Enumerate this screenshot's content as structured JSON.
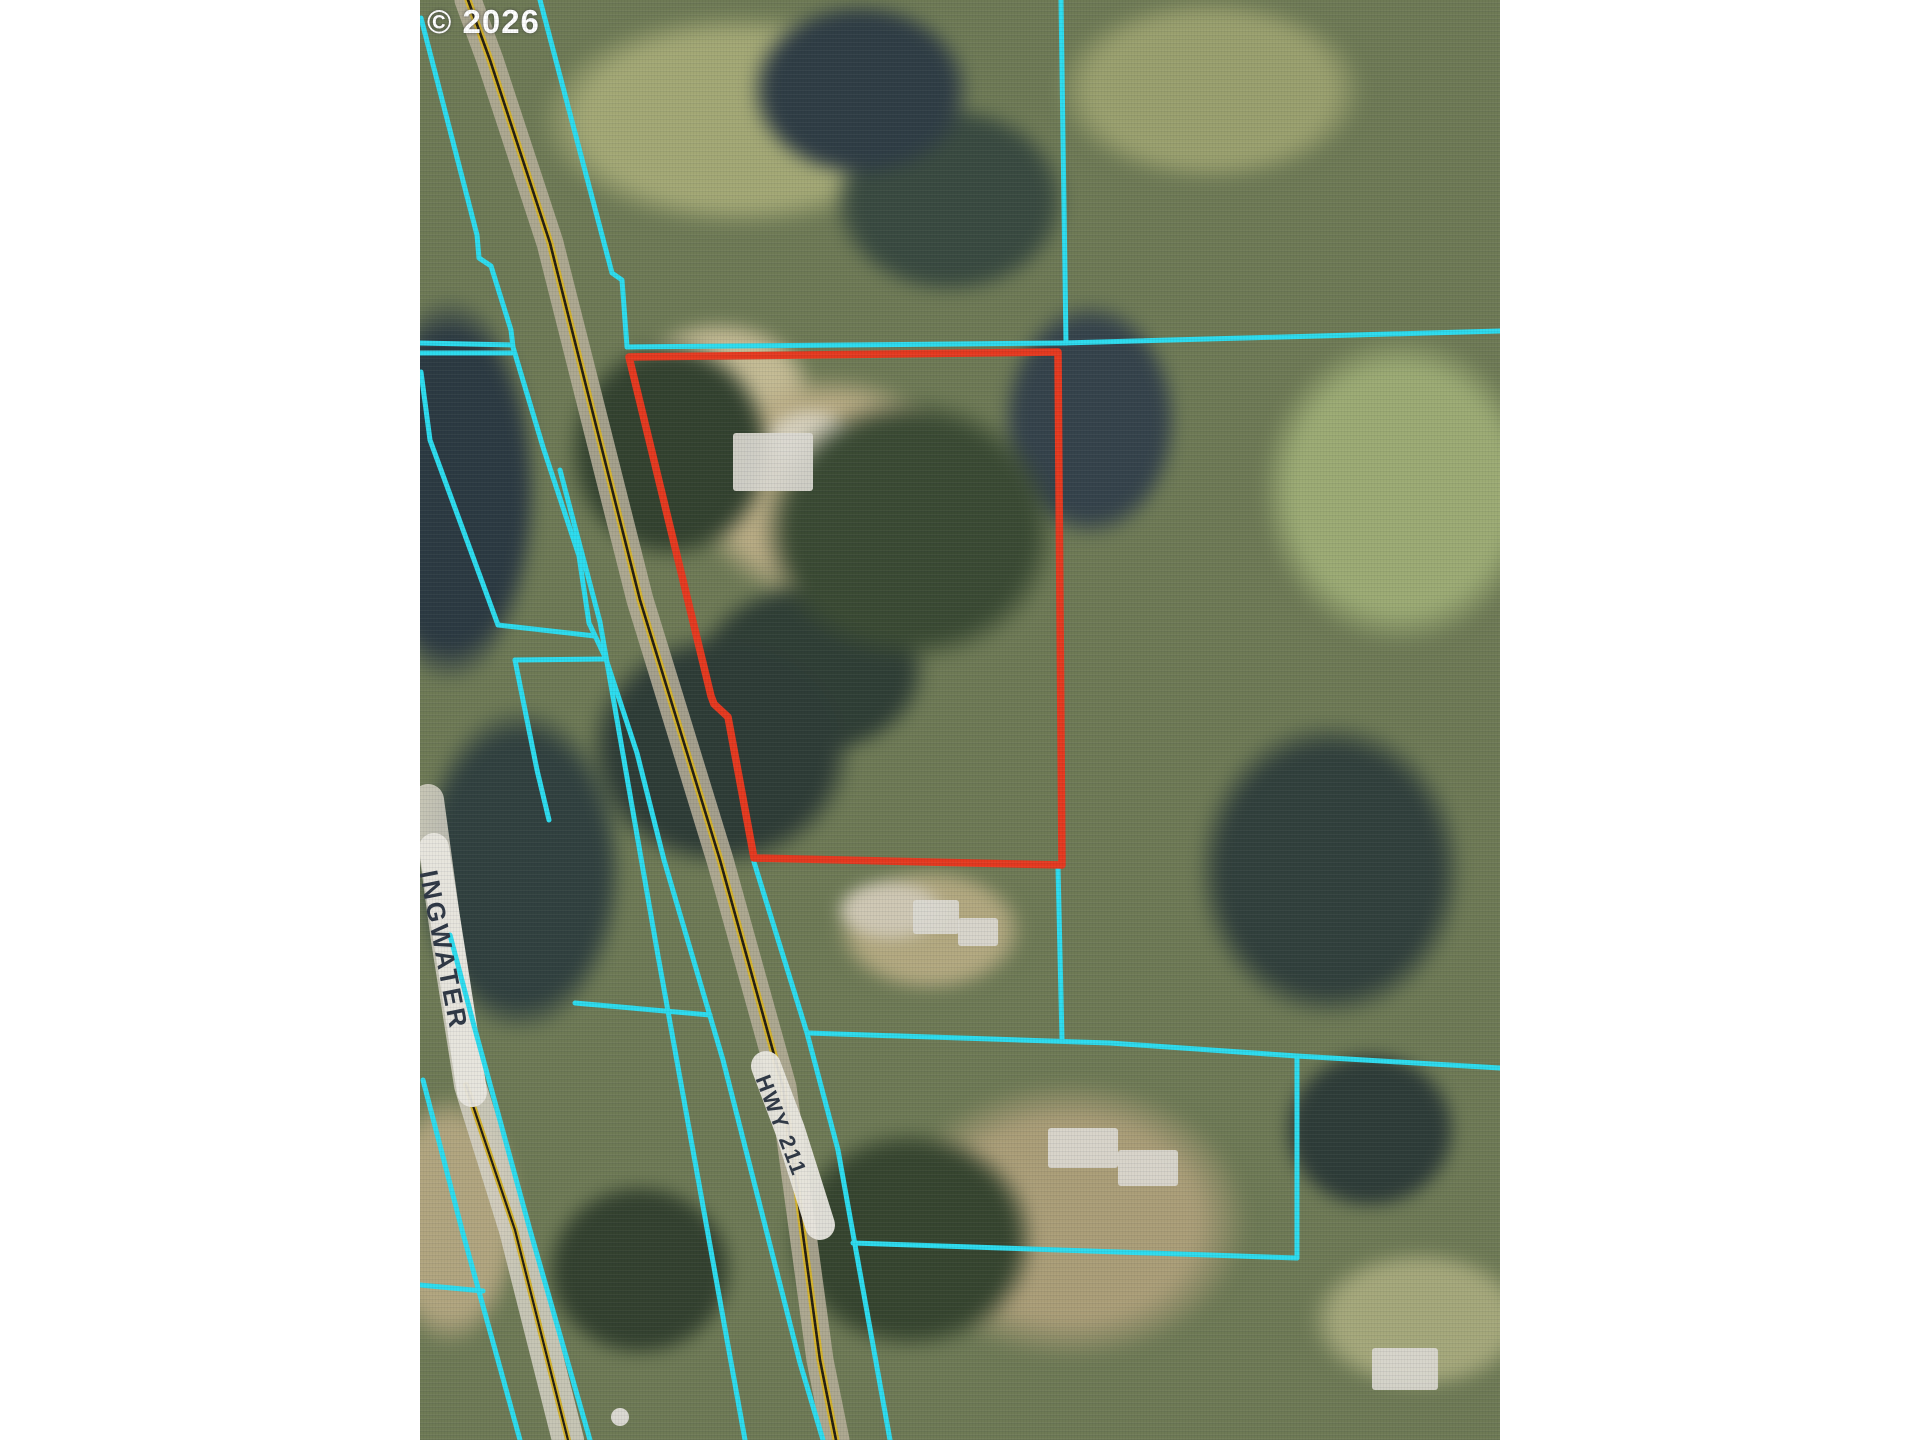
{
  "page": {
    "width": 1920,
    "height": 1440,
    "margin_color": "#ffffff"
  },
  "map": {
    "x": 420,
    "y": 0,
    "width": 1080,
    "height": 1440
  },
  "labels": {
    "copyright": {
      "text": "© 2026",
      "x": 427,
      "y": 5,
      "size": 33,
      "rotation": 0,
      "color": "#ffffff",
      "letter_spacing": 1
    },
    "road_left": {
      "text": "INGWATER",
      "x": 441,
      "y": 868,
      "size": 26,
      "rotation": 79,
      "color": "#2f3845",
      "letter_spacing": 3
    },
    "road_hwy": {
      "text": "HWY 211",
      "x": 772,
      "y": 1072,
      "size": 22,
      "rotation": 69,
      "color": "#2f3845",
      "letter_spacing": 2
    }
  },
  "colors": {
    "parcel_highlight": "#e5391f",
    "parcel_lines": "#2ddcee",
    "road_yellow": "#d4b32c",
    "road_gap_dark": "#241e12",
    "road_surface_hwy": "#b9b09b",
    "road_surface_spring": "#d6d2c6",
    "label_band": "#e9e7df",
    "structure_fill": "#dbd9d1"
  },
  "layers": {
    "red_parcel": {
      "closed": true,
      "width": 7.5,
      "points": [
        [
          629,
          357
        ],
        [
          1058,
          352
        ],
        [
          1062,
          865
        ],
        [
          754,
          858
        ],
        [
          728,
          717
        ],
        [
          714,
          704
        ],
        [
          711,
          696
        ]
      ]
    },
    "cyan_lines": [
      {
        "points": [
          [
            540,
            0
          ],
          [
            612,
            273
          ],
          [
            622,
            280
          ],
          [
            627,
            347
          ]
        ]
      },
      {
        "points": [
          [
            627,
            347
          ],
          [
            1063,
            343
          ],
          [
            1500,
            331
          ]
        ]
      },
      {
        "points": [
          [
            1061,
            0
          ],
          [
            1066,
            343
          ]
        ]
      },
      {
        "points": [
          [
            754,
            862
          ],
          [
            807,
            1033
          ],
          [
            838,
            1150
          ],
          [
            890,
            1440
          ]
        ]
      },
      {
        "points": [
          [
            1058,
            867
          ],
          [
            1062,
            1040
          ]
        ]
      },
      {
        "points": [
          [
            808,
            1033
          ],
          [
            1110,
            1043
          ],
          [
            1297,
            1056
          ],
          [
            1500,
            1068
          ]
        ]
      },
      {
        "points": [
          [
            1297,
            1056
          ],
          [
            1297,
            1258
          ]
        ]
      },
      {
        "points": [
          [
            853,
            1243
          ],
          [
            1297,
            1258
          ]
        ]
      },
      {
        "points": [
          [
            560,
            470
          ],
          [
            600,
            622
          ],
          [
            657,
            950
          ],
          [
            745,
            1440
          ]
        ]
      },
      {
        "points": [
          [
            421,
            18
          ],
          [
            477,
            235
          ],
          [
            479,
            258
          ],
          [
            491,
            266
          ],
          [
            511,
            330
          ],
          [
            513,
            347
          ],
          [
            543,
            447
          ],
          [
            579,
            556
          ],
          [
            589,
            623
          ],
          [
            606,
            659
          ],
          [
            637,
            753
          ],
          [
            664,
            860
          ],
          [
            723,
            1060
          ],
          [
            800,
            1363
          ],
          [
            823,
            1440
          ]
        ]
      },
      {
        "points": [
          [
            423,
            1080
          ],
          [
            462,
            1230
          ],
          [
            520,
            1440
          ]
        ]
      },
      {
        "points": [
          [
            450,
            935
          ],
          [
            473,
            1022
          ],
          [
            530,
            1230
          ],
          [
            590,
            1440
          ]
        ]
      },
      {
        "points": [
          [
            420,
            343
          ],
          [
            512,
            345
          ]
        ]
      },
      {
        "points": [
          [
            420,
            353
          ],
          [
            512,
            353
          ]
        ]
      },
      {
        "points": [
          [
            498,
            625
          ],
          [
            595,
            636
          ]
        ]
      },
      {
        "points": [
          [
            515,
            660
          ],
          [
            606,
            659
          ]
        ]
      },
      {
        "points": [
          [
            515,
            660
          ],
          [
            537,
            770
          ],
          [
            549,
            820
          ]
        ]
      },
      {
        "points": [
          [
            421,
            372
          ],
          [
            430,
            440
          ],
          [
            498,
            625
          ]
        ]
      },
      {
        "points": [
          [
            575,
            1003
          ],
          [
            710,
            1015
          ]
        ]
      },
      {
        "points": [
          [
            420,
            1285
          ],
          [
            483,
            1291
          ]
        ]
      }
    ],
    "roads": [
      {
        "name": "hwy-211",
        "points": [
          [
            468,
            0
          ],
          [
            490,
            60
          ],
          [
            550,
            243
          ],
          [
            640,
            600
          ],
          [
            720,
            860
          ],
          [
            783,
            1087
          ],
          [
            820,
            1360
          ],
          [
            836,
            1440
          ]
        ],
        "surface_width": 27,
        "yellow_width": 7,
        "gap_width": 2.6,
        "surface": "hwy"
      },
      {
        "name": "springwater",
        "points": [
          [
            466,
            1085
          ],
          [
            515,
            1230
          ],
          [
            568,
            1440
          ]
        ],
        "surface_width": 32,
        "yellow_width": 6,
        "gap_width": 2.2,
        "surface": "spring",
        "surface_points": [
          [
            428,
            800
          ],
          [
            447,
            940
          ],
          [
            470,
            1085
          ],
          [
            515,
            1230
          ],
          [
            568,
            1440
          ]
        ]
      }
    ],
    "label_bands": [
      {
        "points": [
          [
            434,
            848
          ],
          [
            452,
            962
          ],
          [
            472,
            1092
          ]
        ],
        "width": 30
      },
      {
        "points": [
          [
            766,
            1066
          ],
          [
            790,
            1130
          ],
          [
            820,
            1225
          ]
        ],
        "width": 30
      }
    ],
    "structures": {
      "rects": [
        {
          "x": 733,
          "y": 433,
          "w": 80,
          "h": 58
        },
        {
          "x": 913,
          "y": 900,
          "w": 46,
          "h": 34
        },
        {
          "x": 958,
          "y": 918,
          "w": 40,
          "h": 28
        },
        {
          "x": 1048,
          "y": 1128,
          "w": 70,
          "h": 40
        },
        {
          "x": 1118,
          "y": 1150,
          "w": 60,
          "h": 36
        },
        {
          "x": 1372,
          "y": 1348,
          "w": 66,
          "h": 42
        }
      ],
      "circles": [
        {
          "cx": 620,
          "cy": 1417,
          "r": 9
        }
      ]
    }
  }
}
